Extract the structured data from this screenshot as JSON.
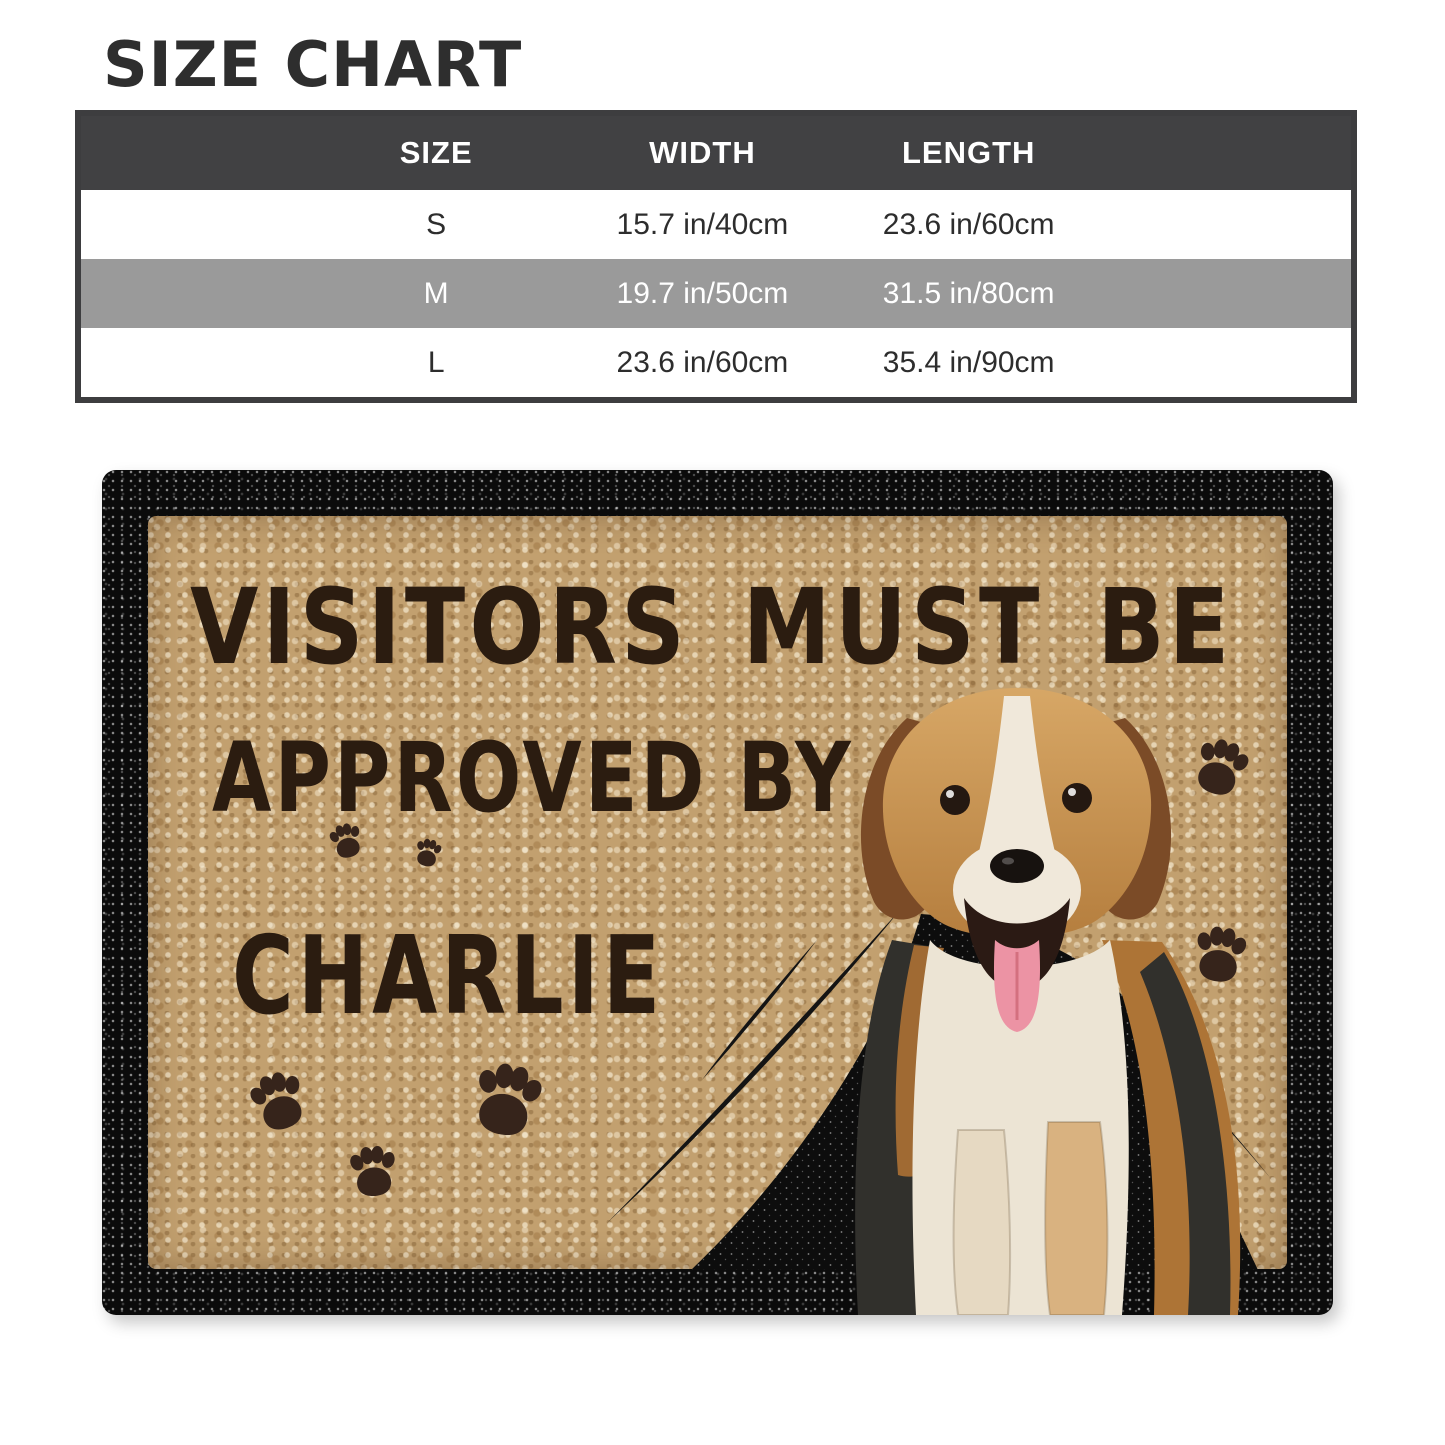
{
  "size_chart": {
    "title": "SIZE CHART",
    "columns": [
      "SIZE",
      "WIDTH",
      "LENGTH"
    ],
    "rows": [
      {
        "size": "S",
        "width": "15.7 in/40cm",
        "length": "23.6 in/60cm"
      },
      {
        "size": "M",
        "width": "19.7 in/50cm",
        "length": "31.5 in/80cm"
      },
      {
        "size": "L",
        "width": "23.6 in/60cm",
        "length": "35.4 in/90cm"
      }
    ]
  },
  "doormat": {
    "line1": "VISITORS MUST BE",
    "line2": "APPROVED BY",
    "pet_name": "CHARLIE",
    "subject": "beagle-dog-photo",
    "colors": {
      "mat_tan": "#c2a06f",
      "text_brown": "#2b1c10",
      "border_black": "#0b0b0b",
      "paw_brown": "#36241b",
      "header_dark": "#414143",
      "row_gray": "#9a9a9a"
    }
  }
}
